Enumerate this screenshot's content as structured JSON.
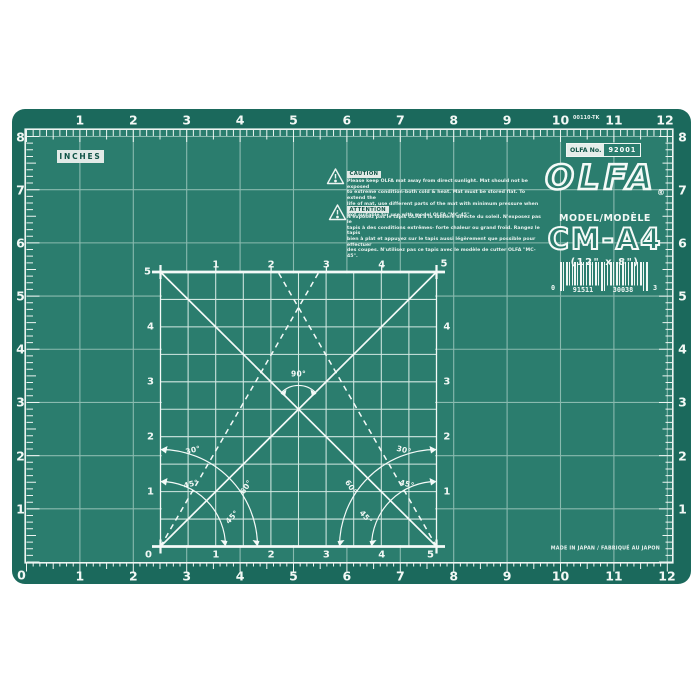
{
  "colors": {
    "mat_border": "#1b695c",
    "mat_surface": "#2b7d6e",
    "grid_line": "#d7ece6",
    "marking": "#f2f8f5"
  },
  "plate_number": "00110-TK",
  "rulers": {
    "unit_label": "INCHES",
    "top": [
      "1",
      "2",
      "3",
      "4",
      "5",
      "6",
      "7",
      "8",
      "9",
      "10",
      "11",
      "12"
    ],
    "bottom": [
      "1",
      "2",
      "3",
      "4",
      "5",
      "6",
      "7",
      "8",
      "9",
      "10",
      "11",
      "12"
    ],
    "left": [
      "8",
      "7",
      "6",
      "5",
      "4",
      "3",
      "2",
      "1",
      "0"
    ],
    "right": [
      "8",
      "7",
      "6",
      "5",
      "4",
      "3",
      "2",
      "1"
    ]
  },
  "item_badge": {
    "prefix": "OLFA No.",
    "number": "92001"
  },
  "caution": {
    "title": "CAUTION",
    "lines": [
      "Please keep OLFA mat away from direct sunlight. Mat should not be exposed",
      "to extreme condition-both cold & heat. Mat must be stored flat. To extend the",
      "life of mat, use different parts of the mat with minimum pressure when cutting.",
      "Not suitable for use with model OLFA \"MC-45\"."
    ]
  },
  "attention": {
    "title": "ATTENTION",
    "lines": [
      "N'exposez pas le tapis OLFA à la lumière directe du soleil. N'exposez pas le",
      "tapis à des conditions extrêmes- forte chaleur ou grand froid. Rangez le tapis",
      "bien à plat et appuyez sur le tapis aussi légèrement que possible pour effectuer",
      "des coupes. N'utilisez pas ce tapis avec le modèle de cutter OLFA \"MC-45\"."
    ]
  },
  "brand": {
    "logo": "OLFA",
    "registered": "®",
    "model_label": "MODEL/MODÈLE",
    "model": "CM-A4",
    "size": "(12\" x 8\")"
  },
  "barcode": {
    "left_digit": "0",
    "group1": "91511",
    "group2": "30038",
    "right_digit": "3"
  },
  "square": {
    "top_labels": [
      "5",
      "1",
      "2",
      "3",
      "4",
      "5"
    ],
    "bottom_labels": [
      "0",
      "1",
      "2",
      "3",
      "4",
      "5"
    ],
    "left_labels": [
      "4",
      "3",
      "2",
      "1"
    ],
    "right_labels": [
      "4",
      "3",
      "2",
      "1"
    ],
    "angle_labels_left": [
      "30°",
      "45°",
      "60°",
      "45°"
    ],
    "angle_labels_right": [
      "30°",
      "45°",
      "60°",
      "45°"
    ],
    "right_angle_label": "90°"
  },
  "footer": {
    "made_in": "MADE IN JAPAN / FABRIQUÉ AU JAPON"
  }
}
